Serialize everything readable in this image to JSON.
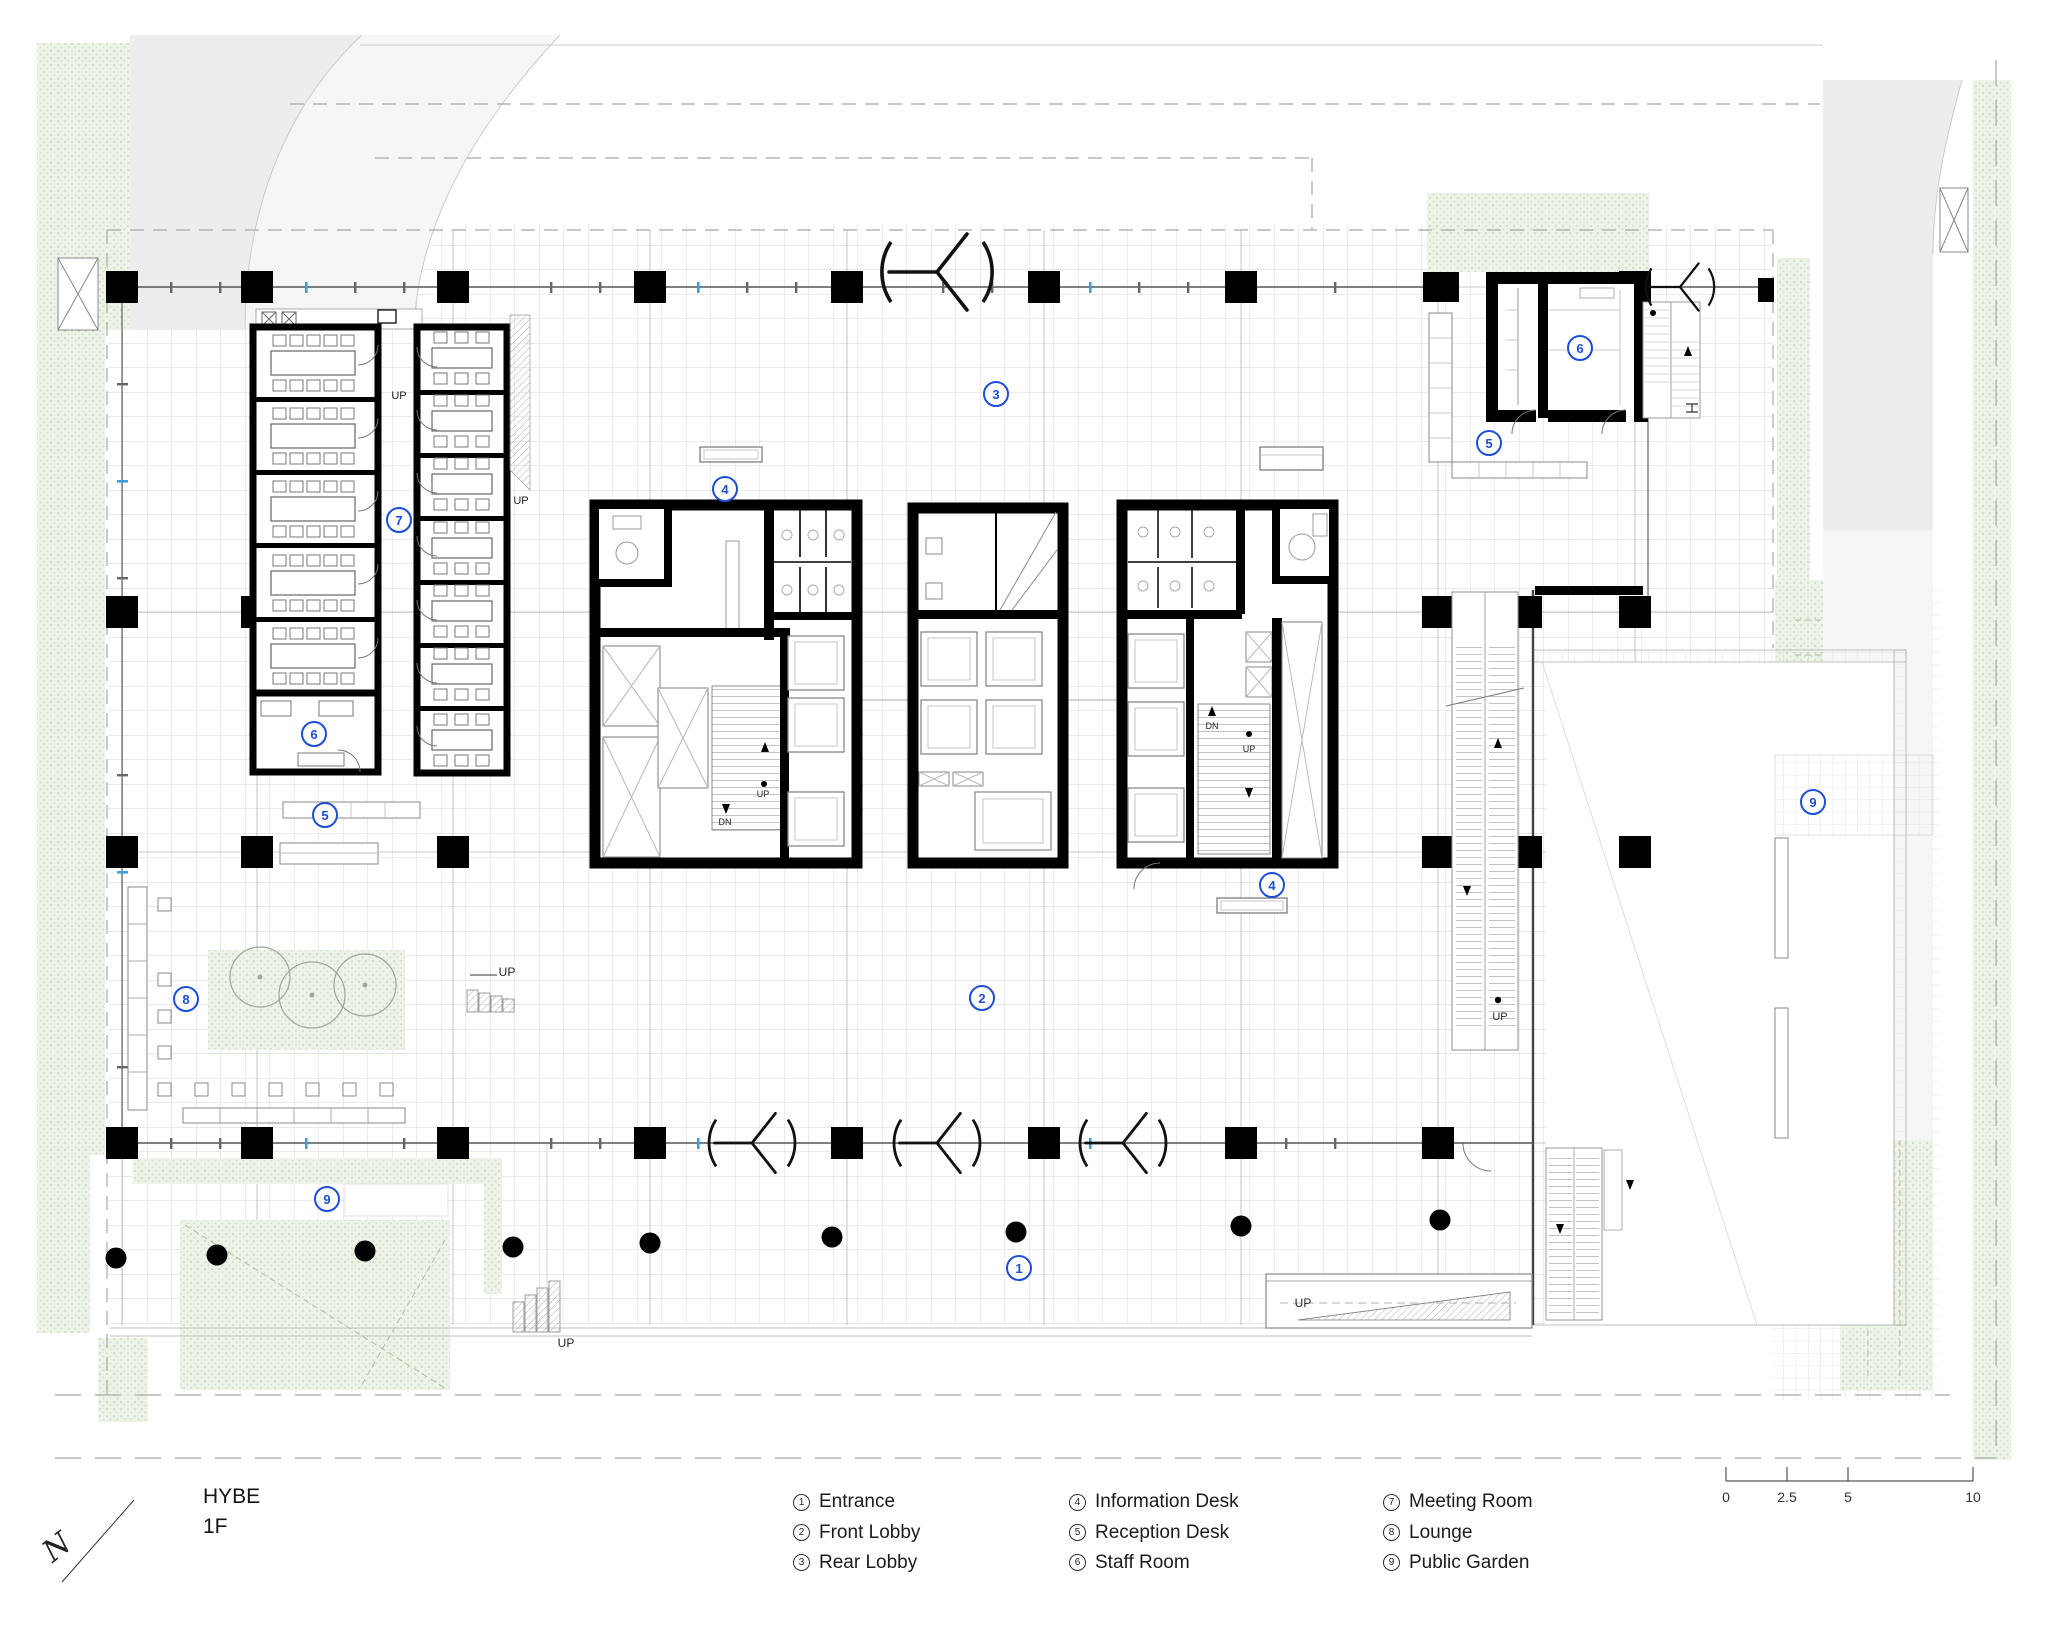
{
  "title": {
    "name": "HYBE",
    "floor": "1F"
  },
  "legend": {
    "columns": [
      {
        "items": [
          {
            "num": "1",
            "label": "Entrance"
          },
          {
            "num": "2",
            "label": "Front Lobby"
          },
          {
            "num": "3",
            "label": "Rear Lobby"
          }
        ]
      },
      {
        "items": [
          {
            "num": "4",
            "label": "Information Desk"
          },
          {
            "num": "5",
            "label": "Reception Desk"
          },
          {
            "num": "6",
            "label": "Staff Room"
          }
        ]
      },
      {
        "items": [
          {
            "num": "7",
            "label": "Meeting Room"
          },
          {
            "num": "8",
            "label": "Lounge"
          },
          {
            "num": "9",
            "label": "Public Garden"
          }
        ]
      }
    ]
  },
  "scale_bar": {
    "labels": [
      "0",
      "2.5",
      "5",
      "10"
    ]
  },
  "north": {
    "label": "N"
  },
  "markers": [
    {
      "num": "1",
      "x": 1019,
      "y": 1268
    },
    {
      "num": "2",
      "x": 982,
      "y": 998
    },
    {
      "num": "3",
      "x": 996,
      "y": 394
    },
    {
      "num": "4",
      "x": 725,
      "y": 489
    },
    {
      "num": "4",
      "x": 1272,
      "y": 885
    },
    {
      "num": "5",
      "x": 325,
      "y": 815
    },
    {
      "num": "5",
      "x": 1489,
      "y": 443
    },
    {
      "num": "6",
      "x": 314,
      "y": 734
    },
    {
      "num": "6",
      "x": 1580,
      "y": 348
    },
    {
      "num": "7",
      "x": 399,
      "y": 520
    },
    {
      "num": "8",
      "x": 186,
      "y": 999
    },
    {
      "num": "9",
      "x": 327,
      "y": 1199
    },
    {
      "num": "9",
      "x": 1813,
      "y": 802
    }
  ],
  "plan_labels": [
    {
      "text": "UP",
      "x": 399,
      "y": 396,
      "size": 11
    },
    {
      "text": "UP",
      "x": 521,
      "y": 501,
      "size": 11
    },
    {
      "text": "UP",
      "x": 763,
      "y": 794,
      "size": 9
    },
    {
      "text": "DN",
      "x": 725,
      "y": 822,
      "size": 9
    },
    {
      "text": "DN",
      "x": 1212,
      "y": 726,
      "size": 9
    },
    {
      "text": "UP",
      "x": 1249,
      "y": 749,
      "size": 9
    },
    {
      "text": "UP",
      "x": 507,
      "y": 972,
      "size": 12
    },
    {
      "text": "UP",
      "x": 566,
      "y": 1343,
      "size": 12
    },
    {
      "text": "UP",
      "x": 1303,
      "y": 1303,
      "size": 12
    },
    {
      "text": "UP",
      "x": 1500,
      "y": 1017,
      "size": 11
    }
  ],
  "colors": {
    "marker_blue": "#1e4ed8",
    "garden_green": "#ecf2e6",
    "wall_black": "#000000"
  }
}
